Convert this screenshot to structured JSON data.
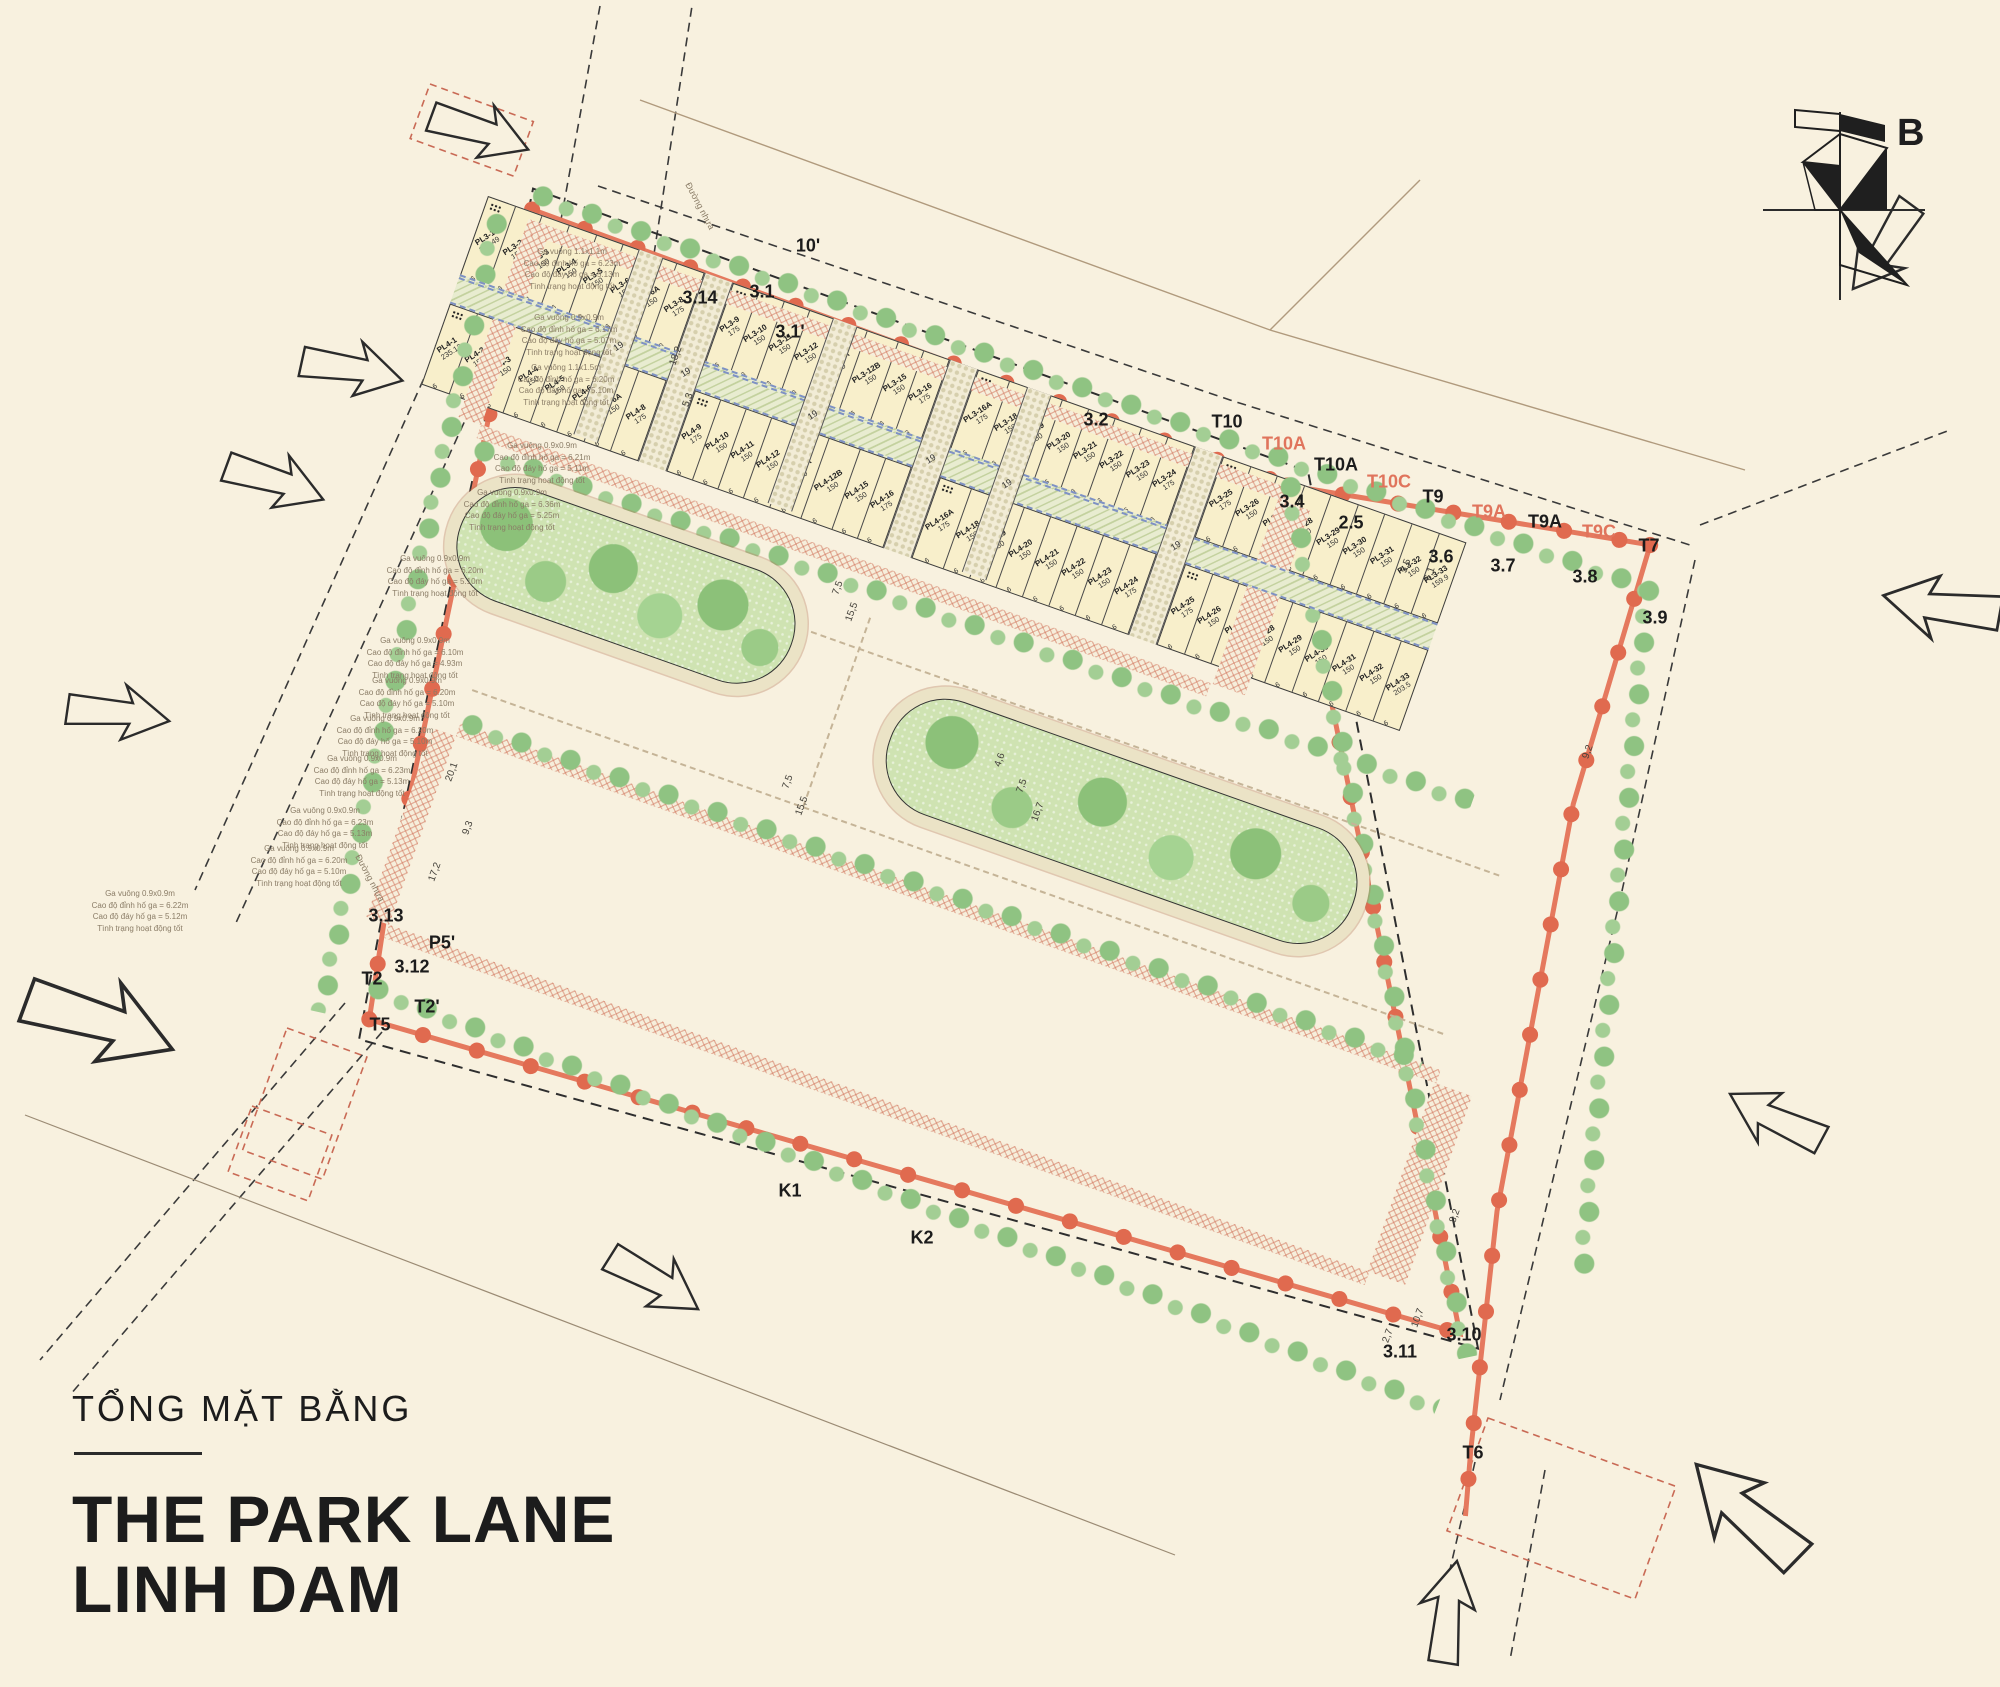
{
  "title": {
    "subtitle": "TỔNG MẶT BẰNG",
    "line1": "THE PARK LANE",
    "line2": "LINH DAM"
  },
  "compass": {
    "label": "B"
  },
  "colors": {
    "background": "#f8f1df",
    "boundary": "#e5795e",
    "lot_fill": "#f8efcb",
    "park_green": "#8cc179",
    "walk_dash": "#7e91c4"
  },
  "site": {
    "alley_label": "19",
    "frontage": "6",
    "upper": {
      "x": 70,
      "y": 22,
      "rowH": 83,
      "walkH": 30,
      "alleyW": 26,
      "alleys": [
        160,
        366,
        572
      ],
      "blocks": [
        {
          "x": 0,
          "w": 160,
          "top": [
            {
              "id": "PL1-1",
              "a": "224.25"
            },
            {
              "id": "PL1-2",
              "a": "150"
            },
            {
              "id": "PL1-3",
              "a": "150"
            },
            {
              "id": "PL1-4",
              "a": "150"
            },
            {
              "id": "PL1-5",
              "a": "150"
            },
            {
              "id": "PL1-6",
              "a": "175"
            }
          ],
          "bottom": [
            {
              "id": "PL2-1",
              "a": "155.9"
            },
            {
              "id": "PL2-2",
              "a": "150"
            },
            {
              "id": "PL2-3",
              "a": "150"
            },
            {
              "id": "PL2-4",
              "a": "150"
            },
            {
              "id": "PL2-5",
              "a": "150"
            },
            {
              "id": "PL2-6",
              "a": "150"
            },
            {
              "id": "PL2-6A",
              "a": "175"
            }
          ]
        },
        {
          "x": 186,
          "w": 180,
          "top": [
            {
              "id": "PL1-6A",
              "a": "175"
            },
            {
              "id": "PL1-8",
              "a": "150"
            },
            {
              "id": "PL1-9",
              "a": "150"
            },
            {
              "id": "PL1-10",
              "a": "150"
            },
            {
              "id": "PL1-11",
              "a": "150"
            },
            {
              "id": "PL1-12",
              "a": "150"
            },
            {
              "id": "PL1-12A",
              "a": "150"
            },
            {
              "id": "PL1-12B",
              "a": "175"
            }
          ],
          "bottom": [
            {
              "id": "PL2-8",
              "a": "175"
            },
            {
              "id": "PL2-9",
              "a": "150"
            },
            {
              "id": "PL2-10",
              "a": "150"
            },
            {
              "id": "PL2-11",
              "a": "150"
            },
            {
              "id": "PL2-12",
              "a": "150"
            },
            {
              "id": "PL2-12A",
              "a": "150"
            },
            {
              "id": "PL2-12B",
              "a": "150"
            },
            {
              "id": "PL2-15",
              "a": "175"
            }
          ]
        },
        {
          "x": 392,
          "w": 180,
          "top": [
            {
              "id": "PL1-15",
              "a": "175"
            },
            {
              "id": "PL1-16",
              "a": "150"
            },
            {
              "id": "PL1-16A",
              "a": "150"
            },
            {
              "id": "PL1-18",
              "a": "151.65"
            },
            {
              "id": "PL1-19",
              "a": "153.37"
            },
            {
              "id": "PL1-20",
              "a": "155.65"
            },
            {
              "id": "PL1-21",
              "a": "158.6"
            },
            {
              "id": "PL1-22",
              "a": "189.53"
            }
          ],
          "bottom": [
            {
              "id": "PL2-16",
              "a": "175"
            },
            {
              "id": "PL2-16A",
              "a": "150"
            },
            {
              "id": "PL2-18",
              "a": "150"
            },
            {
              "id": "PL2-19",
              "a": "150"
            },
            {
              "id": "PL2-20",
              "a": "150"
            },
            {
              "id": "PL2-21",
              "a": "150"
            },
            {
              "id": "PL2-22",
              "a": "150"
            },
            {
              "id": "PL2-23",
              "a": "175"
            }
          ]
        },
        {
          "x": 598,
          "w": 176,
          "top": [
            {
              "id": "PL1-23",
              "a": "200.38"
            },
            {
              "id": "PL1-24",
              "a": "177.7"
            },
            {
              "id": "PL1-25",
              "a": "183.84"
            },
            {
              "id": "PL1-26",
              "a": "190.61"
            },
            {
              "id": "PL1-27",
              "a": "198.03"
            },
            {
              "id": "PL1-28",
              "a": "203.69"
            },
            {
              "id": "PL1-29",
              "a": "234.5"
            }
          ],
          "bottom": [
            {
              "id": "PL2-24",
              "a": "175"
            },
            {
              "id": "PL2-25",
              "a": "150"
            },
            {
              "id": "PL2-26",
              "a": "150"
            },
            {
              "id": "PL2-27",
              "a": "150"
            },
            {
              "id": "PL2-28",
              "a": "150"
            },
            {
              "id": "PL2-29",
              "a": "150"
            },
            {
              "id": "PL2-30",
              "a": "248.09"
            }
          ]
        }
      ]
    },
    "lower": {
      "x": 150,
      "y": 520,
      "rowH": 86,
      "walkH": 28,
      "alleyW": 30,
      "alleys": [
        230,
        490,
        750
      ],
      "blocks": [
        {
          "x": 0,
          "w": 230,
          "top": [
            {
              "id": "PL3-1",
              "a": "186.49"
            },
            {
              "id": "PL3-2",
              "a": "150"
            },
            {
              "id": "PL3-3",
              "a": "150"
            },
            {
              "id": "PL3-4",
              "a": "150"
            },
            {
              "id": "PL3-5",
              "a": "150"
            },
            {
              "id": "PL3-6",
              "a": "150"
            },
            {
              "id": "PL3-6A",
              "a": "150"
            },
            {
              "id": "PL3-8",
              "a": "175"
            }
          ],
          "bottom": [
            {
              "id": "PL4-1",
              "a": "235.12"
            },
            {
              "id": "PL4-2",
              "a": "150"
            },
            {
              "id": "PL4-3",
              "a": "150"
            },
            {
              "id": "PL4-4",
              "a": "150"
            },
            {
              "id": "PL4-5",
              "a": "150"
            },
            {
              "id": "PL4-6",
              "a": "150"
            },
            {
              "id": "PL4-6A",
              "a": "150"
            },
            {
              "id": "PL4-8",
              "a": "175"
            }
          ]
        },
        {
          "x": 260,
          "w": 230,
          "top": [
            {
              "id": "PL3-9",
              "a": "175"
            },
            {
              "id": "PL3-10",
              "a": "150"
            },
            {
              "id": "PL3-11",
              "a": "150"
            },
            {
              "id": "PL3-12",
              "a": "150"
            },
            {
              "id": "PL3-12A",
              "a": "150"
            },
            {
              "id": "PL3-12B",
              "a": "150"
            },
            {
              "id": "PL3-15",
              "a": "150"
            },
            {
              "id": "PL3-16",
              "a": "175"
            }
          ],
          "bottom": [
            {
              "id": "PL4-9",
              "a": "175"
            },
            {
              "id": "PL4-10",
              "a": "150"
            },
            {
              "id": "PL4-11",
              "a": "150"
            },
            {
              "id": "PL4-12",
              "a": "150"
            },
            {
              "id": "PL4-12A",
              "a": "150"
            },
            {
              "id": "PL4-12B",
              "a": "150"
            },
            {
              "id": "PL4-15",
              "a": "150"
            },
            {
              "id": "PL4-16",
              "a": "175"
            }
          ]
        },
        {
          "x": 520,
          "w": 230,
          "top": [
            {
              "id": "PL3-16A",
              "a": "175"
            },
            {
              "id": "PL3-18",
              "a": "150"
            },
            {
              "id": "PL3-19",
              "a": "150"
            },
            {
              "id": "PL3-20",
              "a": "150"
            },
            {
              "id": "PL3-21",
              "a": "150"
            },
            {
              "id": "PL3-22",
              "a": "150"
            },
            {
              "id": "PL3-23",
              "a": "150"
            },
            {
              "id": "PL3-24",
              "a": "175"
            }
          ],
          "bottom": [
            {
              "id": "PL4-16A",
              "a": "175"
            },
            {
              "id": "PL4-18",
              "a": "150"
            },
            {
              "id": "PL4-19",
              "a": "150"
            },
            {
              "id": "PL4-20",
              "a": "150"
            },
            {
              "id": "PL4-21",
              "a": "150"
            },
            {
              "id": "PL4-22",
              "a": "150"
            },
            {
              "id": "PL4-23",
              "a": "150"
            },
            {
              "id": "PL4-24",
              "a": "175"
            }
          ]
        },
        {
          "x": 780,
          "w": 258,
          "top": [
            {
              "id": "PL3-25",
              "a": "175"
            },
            {
              "id": "PL3-26",
              "a": "150"
            },
            {
              "id": "PL3-27",
              "a": "150"
            },
            {
              "id": "PL3-28",
              "a": "150"
            },
            {
              "id": "PL3-29",
              "a": "150"
            },
            {
              "id": "PL3-30",
              "a": "150"
            },
            {
              "id": "PL3-31",
              "a": "150"
            },
            {
              "id": "PL3-32",
              "a": "150"
            },
            {
              "id": "PL3-33",
              "a": "159.9"
            }
          ],
          "bottom": [
            {
              "id": "PL4-25",
              "a": "175"
            },
            {
              "id": "PL4-26",
              "a": "150"
            },
            {
              "id": "PL4-27",
              "a": "150"
            },
            {
              "id": "PL4-28",
              "a": "150"
            },
            {
              "id": "PL4-29",
              "a": "150"
            },
            {
              "id": "PL4-30",
              "a": "150"
            },
            {
              "id": "PL4-31",
              "a": "150"
            },
            {
              "id": "PL4-32",
              "a": "150"
            },
            {
              "id": "PL4-33",
              "a": "203.5"
            }
          ]
        }
      ]
    }
  },
  "markers": [
    {
      "t": "10'",
      "x": 808,
      "y": 246
    },
    {
      "t": "3.14",
      "x": 700,
      "y": 298
    },
    {
      "t": "3.1",
      "x": 762,
      "y": 292
    },
    {
      "t": "3.1'",
      "x": 790,
      "y": 332
    },
    {
      "t": "3.2",
      "x": 1096,
      "y": 420
    },
    {
      "t": "T10",
      "x": 1227,
      "y": 422
    },
    {
      "t": "T10A",
      "x": 1284,
      "y": 444,
      "c": "s"
    },
    {
      "t": "T10A",
      "x": 1336,
      "y": 465
    },
    {
      "t": "T10C",
      "x": 1389,
      "y": 482,
      "c": "s"
    },
    {
      "t": "T9",
      "x": 1433,
      "y": 497
    },
    {
      "t": "T9A",
      "x": 1489,
      "y": 512,
      "c": "s"
    },
    {
      "t": "T9A",
      "x": 1545,
      "y": 522
    },
    {
      "t": "T9C",
      "x": 1599,
      "y": 532,
      "c": "s"
    },
    {
      "t": "T7",
      "x": 1649,
      "y": 546
    },
    {
      "t": "3.4",
      "x": 1292,
      "y": 502
    },
    {
      "t": "2.5",
      "x": 1351,
      "y": 523
    },
    {
      "t": "3.6",
      "x": 1441,
      "y": 557
    },
    {
      "t": "3.7",
      "x": 1503,
      "y": 566
    },
    {
      "t": "3.8",
      "x": 1585,
      "y": 577
    },
    {
      "t": "3.9",
      "x": 1655,
      "y": 618
    },
    {
      "t": "K1",
      "x": 790,
      "y": 1191
    },
    {
      "t": "K2",
      "x": 922,
      "y": 1238
    },
    {
      "t": "3.10",
      "x": 1464,
      "y": 1335
    },
    {
      "t": "3.11",
      "x": 1400,
      "y": 1352
    },
    {
      "t": "T6",
      "x": 1473,
      "y": 1453
    },
    {
      "t": "P5'",
      "x": 442,
      "y": 943
    },
    {
      "t": "3.12",
      "x": 412,
      "y": 967
    },
    {
      "t": "T2",
      "x": 372,
      "y": 979
    },
    {
      "t": "T2'",
      "x": 427,
      "y": 1007
    },
    {
      "t": "T5",
      "x": 380,
      "y": 1025
    },
    {
      "t": "3.13",
      "x": 386,
      "y": 916
    }
  ],
  "dimensions": [
    {
      "t": "18,2",
      "x": 676,
      "y": 356,
      "r": -70
    },
    {
      "t": "5,3",
      "x": 688,
      "y": 400,
      "r": -70
    },
    {
      "t": "9,3",
      "x": 468,
      "y": 828,
      "r": -70
    },
    {
      "t": "20,1",
      "x": 452,
      "y": 772,
      "r": -70
    },
    {
      "t": "17,2",
      "x": 435,
      "y": 872,
      "r": -70
    },
    {
      "t": "7,5",
      "x": 838,
      "y": 588,
      "r": -70
    },
    {
      "t": "15,5",
      "x": 852,
      "y": 612,
      "r": -70
    },
    {
      "t": "7,5",
      "x": 788,
      "y": 782,
      "r": -70
    },
    {
      "t": "15,5",
      "x": 802,
      "y": 806,
      "r": -70
    },
    {
      "t": "7,5",
      "x": 1022,
      "y": 786,
      "r": -70
    },
    {
      "t": "16,7",
      "x": 1038,
      "y": 812,
      "r": -70
    },
    {
      "t": "4,6",
      "x": 1000,
      "y": 760,
      "r": -70
    },
    {
      "t": "9,2",
      "x": 1588,
      "y": 752,
      "r": -70
    },
    {
      "t": "8,2",
      "x": 1455,
      "y": 1216,
      "r": -70
    },
    {
      "t": "10,7",
      "x": 1418,
      "y": 1318,
      "r": -70
    },
    {
      "t": "2,7",
      "x": 1388,
      "y": 1336,
      "r": -70
    },
    {
      "t": "5,5",
      "x": 1406,
      "y": 566,
      "r": -70
    },
    {
      "t": "6,1",
      "x": 1430,
      "y": 574,
      "r": -70
    }
  ],
  "road_labels": [
    {
      "t": "Đường nhựa",
      "x": 700,
      "y": 206,
      "r": 62
    },
    {
      "t": "Đường nhựa",
      "x": 370,
      "y": 878,
      "r": 62
    }
  ],
  "notes": [
    {
      "x": 572,
      "y": 246,
      "lines": [
        "Ga vuông 1.1x1.1m",
        "Cao độ đỉnh hố ga = 6.23m",
        "Cao độ đáy hố ga = 5.13m",
        "Tình trạng hoạt động tốt"
      ]
    },
    {
      "x": 569,
      "y": 312,
      "lines": [
        "Ga vuông 0.9x0.9m",
        "Cao độ đỉnh hố ga = 6.17m",
        "Cao độ đáy hố ga = 5.07m",
        "Tình trạng hoạt động tốt"
      ]
    },
    {
      "x": 566,
      "y": 362,
      "lines": [
        "Ga vuông 1.1x1.5m",
        "Cao độ đỉnh hố ga = 6.20m",
        "Cao độ đáy hố ga = 5.10m",
        "Tình trạng hoạt động tốt"
      ]
    },
    {
      "x": 542,
      "y": 440,
      "lines": [
        "Ga vuông 0.9x0.9m",
        "Cao độ đỉnh hố ga = 6.21m",
        "Cao độ đáy hố ga = 5.11m",
        "Tình trạng hoạt động tốt"
      ]
    },
    {
      "x": 512,
      "y": 487,
      "lines": [
        "Ga vuông 0.9x0.9m",
        "Cao độ đỉnh hố ga = 6.36m",
        "Cao độ đáy hố ga = 5.25m",
        "Tình trạng hoạt động tốt"
      ]
    },
    {
      "x": 435,
      "y": 553,
      "lines": [
        "Ga vuông 0.9x0.9m",
        "Cao độ đỉnh hố ga = 6.20m",
        "Cao độ đáy hố ga = 5.10m",
        "Tình trạng hoạt động tốt"
      ]
    },
    {
      "x": 415,
      "y": 635,
      "lines": [
        "Ga vuông 0.9x0.9m",
        "Cao độ đỉnh hố ga = 6.10m",
        "Cao độ đáy hố ga = 4.93m",
        "Tình trạng hoạt động tốt"
      ]
    },
    {
      "x": 407,
      "y": 675,
      "lines": [
        "Ga vuông 0.9x0.9m",
        "Cao độ đỉnh hố ga = 6.20m",
        "Cao độ đáy hố ga = 5.10m",
        "Tình trạng hoạt động tốt"
      ]
    },
    {
      "x": 385,
      "y": 713,
      "lines": [
        "Ga vuông 0.9x0.9m",
        "Cao độ đỉnh hố ga = 6.20m",
        "Cao độ đáy hố ga = 5.10m",
        "Tình trạng hoạt động tốt"
      ]
    },
    {
      "x": 362,
      "y": 753,
      "lines": [
        "Ga vuông 0.9x0.9m",
        "Cao độ đỉnh hố ga = 6.23m",
        "Cao độ đáy hố ga = 5.13m",
        "Tình trạng hoạt động tốt"
      ]
    },
    {
      "x": 325,
      "y": 805,
      "lines": [
        "Ga vuông 0.9x0.9m",
        "Cao độ đỉnh hố ga = 6.23m",
        "Cao độ đáy hố ga = 5.13m",
        "Tình trạng hoạt động tốt"
      ]
    },
    {
      "x": 299,
      "y": 843,
      "lines": [
        "Ga vuông 0.9x0.9m",
        "Cao độ đỉnh hố ga = 6.20m",
        "Cao độ đáy hố ga = 5.10m",
        "Tình trạng hoạt động tốt"
      ]
    },
    {
      "x": 140,
      "y": 888,
      "lines": [
        "Ga vuông 0.9x0.9m",
        "Cao độ đỉnh hố ga = 6.22m",
        "Cao độ đáy hố ga = 5.12m",
        "Tình trạng hoạt động tốt"
      ]
    }
  ]
}
